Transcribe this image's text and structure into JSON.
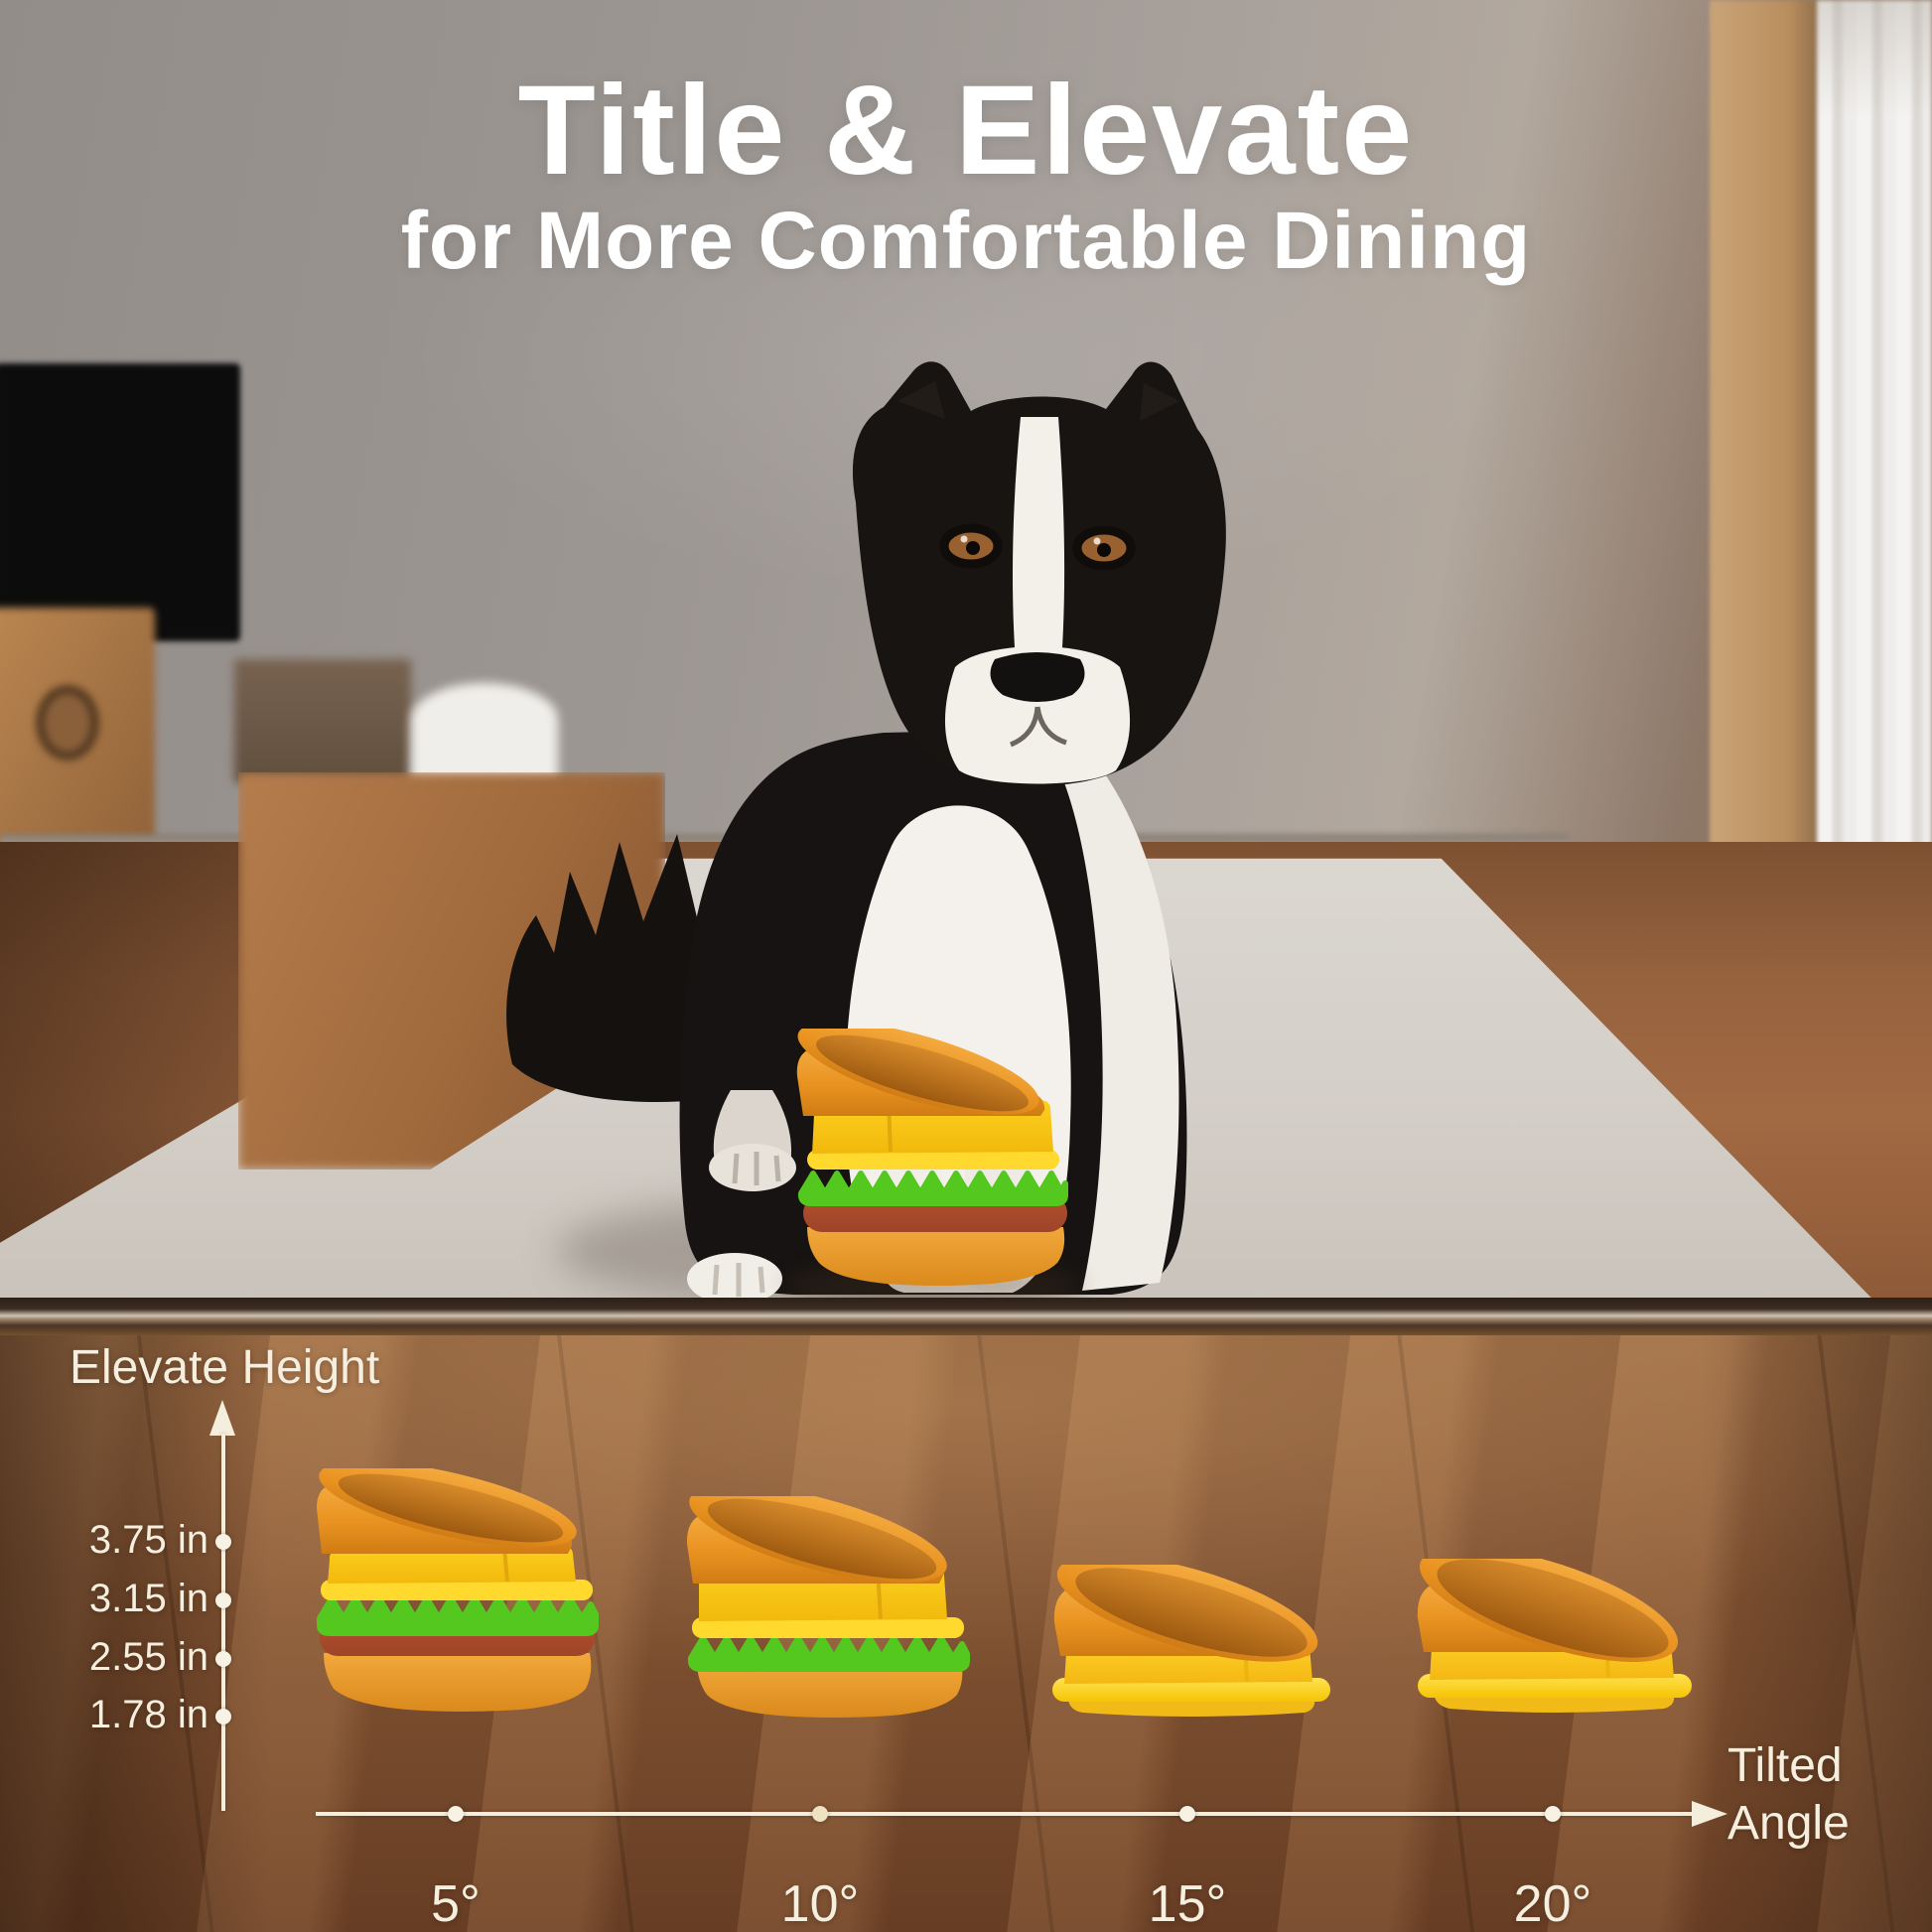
{
  "title": {
    "heading": "Title & Elevate",
    "subheading": "for More Comfortable Dining"
  },
  "diagram": {
    "y_axis_label": "Elevate Height",
    "x_axis_label_line1": "Tilted",
    "x_axis_label_line2": "Angle",
    "height_ticks": [
      "3.75 in",
      "3.15 in",
      "2.55 in",
      "1.78 in"
    ],
    "angle_ticks": [
      "5°",
      "10°",
      "15°",
      "20°"
    ]
  },
  "chart_data": {
    "type": "scatter",
    "x": [
      5,
      10,
      15,
      20
    ],
    "categories": [
      "5°",
      "10°",
      "15°",
      "20°"
    ],
    "values": [
      3.75,
      3.15,
      2.55,
      1.78
    ],
    "xlabel": "Tilted Angle",
    "ylabel": "Elevate Height",
    "x_unit": "deg",
    "y_unit": "in",
    "yticks": [
      3.75,
      3.15,
      2.55,
      1.78
    ],
    "legend": "none",
    "notes": "Four tilted hamburger-stack dog bowls: elevate height decreases as tilted angle increases"
  },
  "illustrations": {
    "photo_subject": "border-collie-dog-sitting-on-mat",
    "product": "hamburger-stack-tilted-elevated-dog-bowl"
  },
  "colors": {
    "bowl_orange": "#EE9B2C",
    "cheese_yellow": "#F9C815",
    "band_yellow": "#FFD82A",
    "lettuce_green": "#55C81F",
    "patty_red": "#AC4C2E",
    "axis_cream": "#F6EFDF",
    "title_white": "#FFFFFF"
  }
}
